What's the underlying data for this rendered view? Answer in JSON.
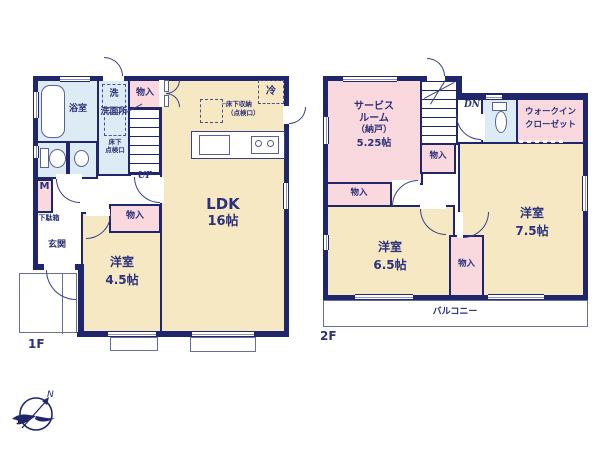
{
  "floor1": {
    "floor_label": "1F",
    "bath": "浴室",
    "washer": "洗",
    "washroom": "洗面所",
    "hall_closet": "物入",
    "underfloor_access_l1": "床下",
    "underfloor_access_l2": "点検口",
    "stairs_up": "UP",
    "meter_box": "M",
    "shoe_cabinet": "下駄箱",
    "entrance": "玄関",
    "bedroom": "洋室",
    "bedroom_size": "4.5帖",
    "bedroom_closet": "物入",
    "ldk": "LDK",
    "ldk_size": "16帖",
    "fridge": "冷",
    "underfloor_storage_l1": "─床下収納",
    "underfloor_storage_l2": "（点検口）"
  },
  "floor2": {
    "floor_label": "2F",
    "service_room_l1": "サービス",
    "service_room_l2": "ルーム",
    "service_room_l3": "（納戸）",
    "service_room_size": "5.25帖",
    "stairs_down": "DN",
    "service_closet": "物入",
    "hall_closet": "物入",
    "walkin_l1": "ウォークイン",
    "walkin_l2": "クローゼット",
    "bedroom_right": "洋室",
    "bedroom_right_size": "7.5帖",
    "bedroom_left": "洋室",
    "bedroom_left_size": "6.5帖",
    "bedroom_closet": "物入",
    "balcony": "バルコニー"
  },
  "compass": {
    "north_label": "N"
  },
  "colors": {
    "wall_navy": "#20266b",
    "room_cream": "#f7e8c4",
    "room_pink": "#f9d9dd",
    "room_blue": "#dcebf4",
    "label_navy": "#2b317c",
    "thin_line": "#6a6f98"
  }
}
